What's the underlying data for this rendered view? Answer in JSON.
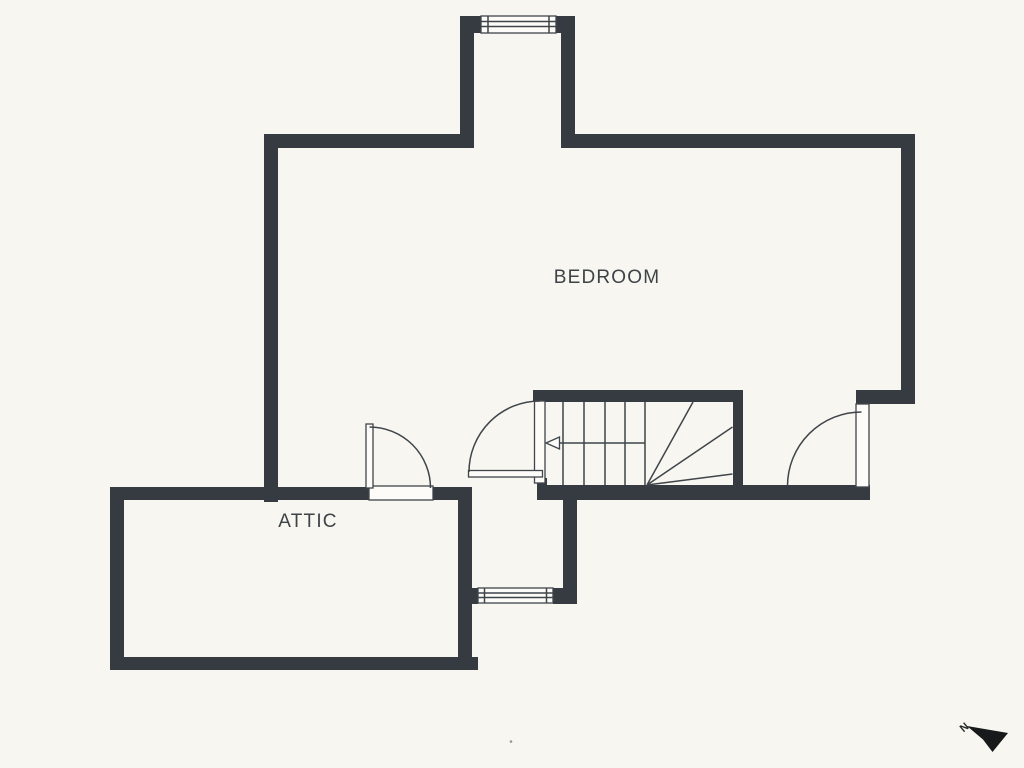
{
  "plan": {
    "colors": {
      "background": "#f7f6f0",
      "wall": "#353b41",
      "line": "#3f454a",
      "paper": "#fdfcf8",
      "text": "#3e4347",
      "compass": "#17191b"
    },
    "labels": {
      "bedroom": "BEDROOM",
      "attic": "ATTIC"
    },
    "compass": {
      "north_label": "N"
    }
  }
}
